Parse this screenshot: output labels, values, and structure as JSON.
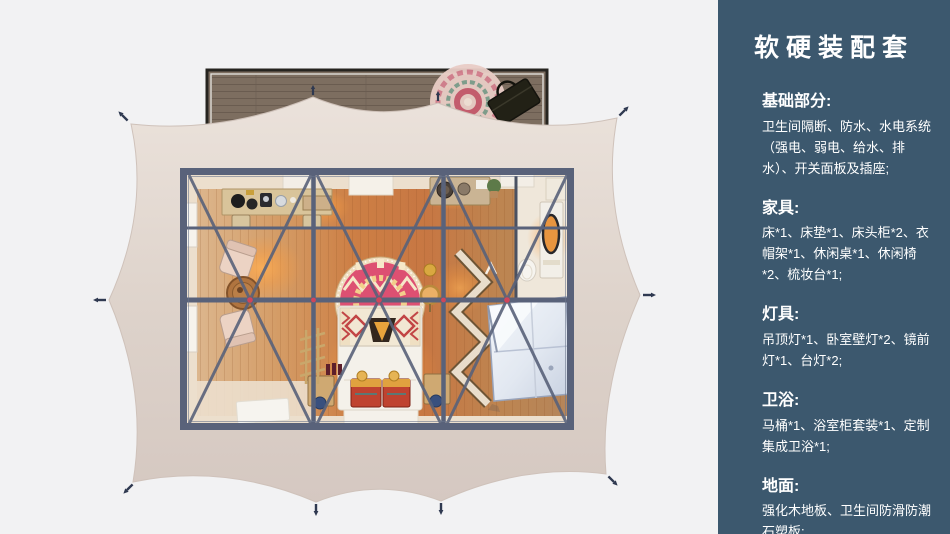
{
  "colors": {
    "background": "#f2f2f3",
    "sidebar_bg": "#3c586e",
    "sidebar_text": "#ffffff",
    "tent_canvas": "#ded3cb",
    "deck_wood": "#7d6e60",
    "deck_frame": "#26241f",
    "room_frame": "#59627a",
    "floor_cream": "#ecdfcd",
    "bed_white": "#f4f1ea",
    "rug_pink": "#dd5072",
    "chest_red": "#bf4330",
    "rack_cream": "#e9ddcb",
    "bath_pod": "#eef1f6",
    "stake": "#2f3950",
    "joint_red": "#d0455a"
  },
  "sidebar": {
    "title": "软硬装配套",
    "sections": [
      {
        "heading": "基础部分:",
        "body": "卫生间隔断、防水、水电系统（强电、弱电、给水、排水）、开关面板及插座;"
      },
      {
        "heading": "家具:",
        "body": "床*1、床垫*1、床头柜*2、衣帽架*1、休闲桌*1、休闲椅*2、梳妆台*1;"
      },
      {
        "heading": "灯具:",
        "body": "吊顶灯*1、卧室壁灯*2、镜前灯*1、台灯*2;"
      },
      {
        "heading": "卫浴:",
        "body": "马桶*1、浴室柜套装*1、定制集成卫浴*1;"
      },
      {
        "heading": "地面:",
        "body": "强化木地板、卫生间防滑防潮石塑板;"
      }
    ]
  }
}
